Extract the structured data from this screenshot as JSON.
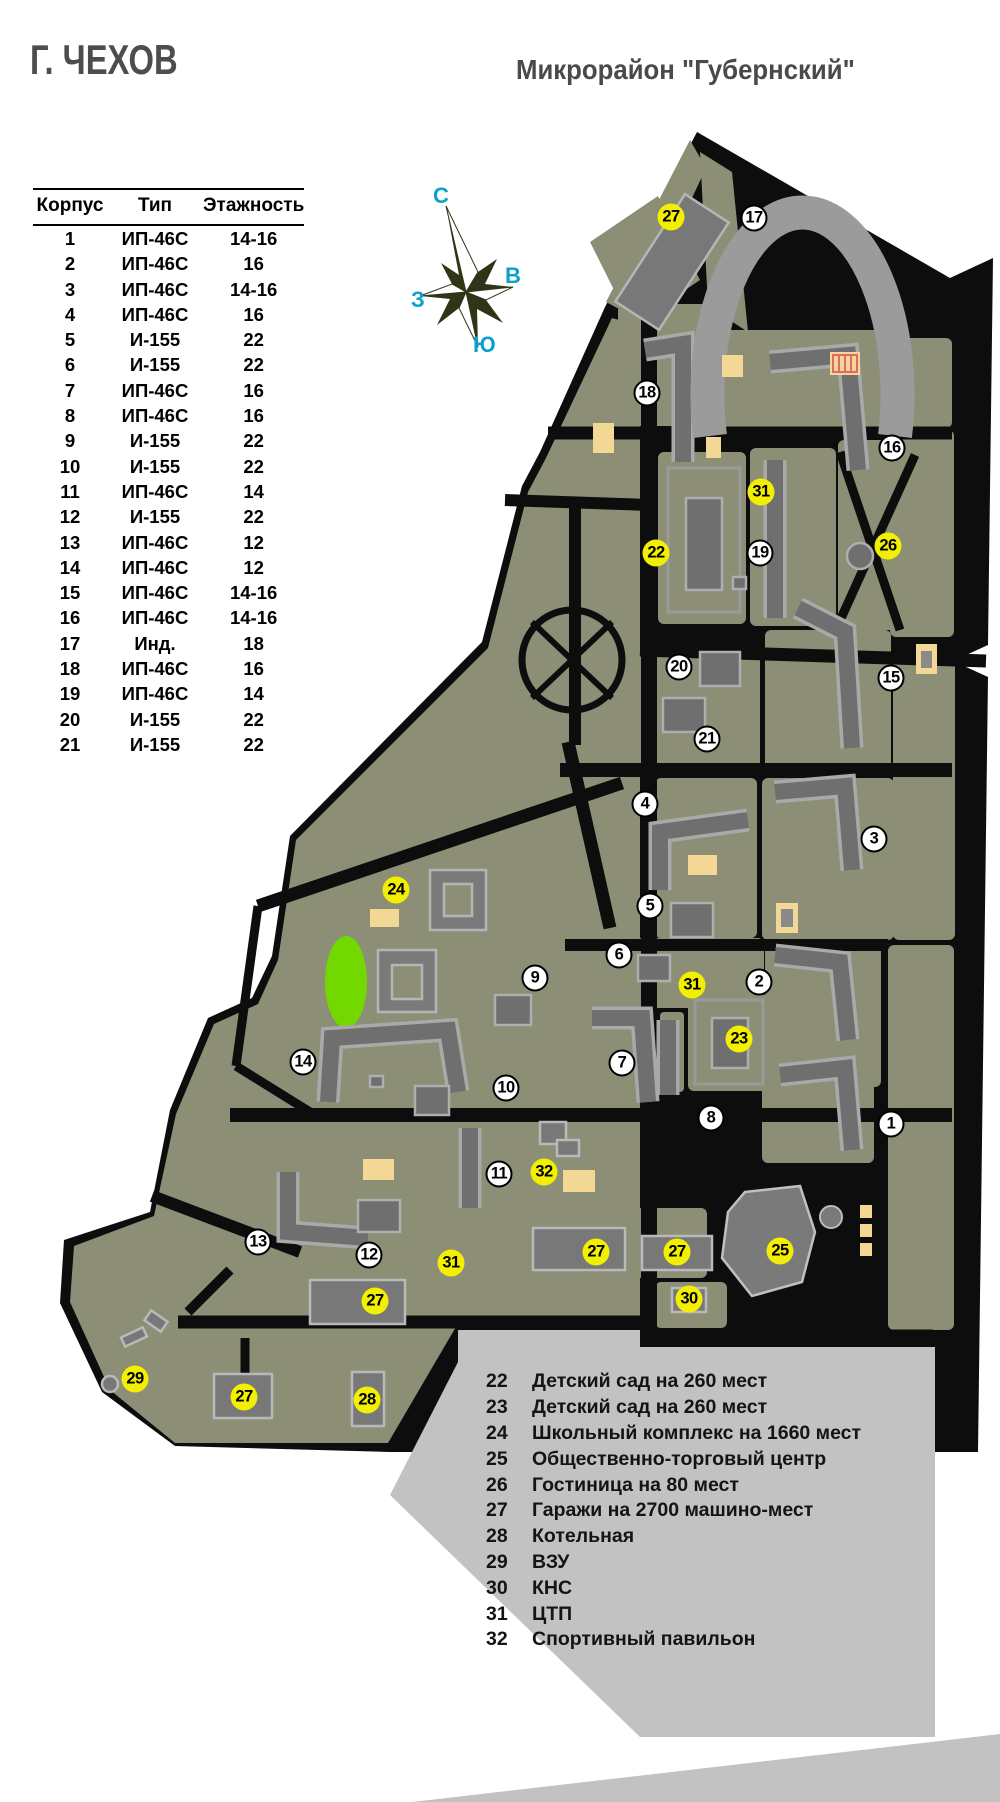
{
  "titles": {
    "city": "Г. ЧЕХОВ",
    "district": "Микрорайон \"Губернский\""
  },
  "table": {
    "headers": [
      "Корпус",
      "Тип",
      "Этажность"
    ],
    "rows": [
      [
        "1",
        "ИП-46С",
        "14-16"
      ],
      [
        "2",
        "ИП-46С",
        "16"
      ],
      [
        "3",
        "ИП-46С",
        "14-16"
      ],
      [
        "4",
        "ИП-46С",
        "16"
      ],
      [
        "5",
        "И-155",
        "22"
      ],
      [
        "6",
        "И-155",
        "22"
      ],
      [
        "7",
        "ИП-46С",
        "16"
      ],
      [
        "8",
        "ИП-46С",
        "16"
      ],
      [
        "9",
        "И-155",
        "22"
      ],
      [
        "10",
        "И-155",
        "22"
      ],
      [
        "11",
        "ИП-46С",
        "14"
      ],
      [
        "12",
        "И-155",
        "22"
      ],
      [
        "13",
        "ИП-46С",
        "12"
      ],
      [
        "14",
        "ИП-46С",
        "12"
      ],
      [
        "15",
        "ИП-46С",
        "14-16"
      ],
      [
        "16",
        "ИП-46С",
        "14-16"
      ],
      [
        "17",
        "Инд.",
        "18"
      ],
      [
        "18",
        "ИП-46С",
        "16"
      ],
      [
        "19",
        "ИП-46С",
        "14"
      ],
      [
        "20",
        "И-155",
        "22"
      ],
      [
        "21",
        "И-155",
        "22"
      ]
    ]
  },
  "compass": {
    "north": "С",
    "east": "В",
    "west": "З",
    "south": "Ю"
  },
  "legend": {
    "items": [
      {
        "num": "22",
        "label": "Детский сад на 260 мест"
      },
      {
        "num": "23",
        "label": "Детский сад на 260 мест"
      },
      {
        "num": "24",
        "label": "Школьный комплекс на 1660 мест"
      },
      {
        "num": "25",
        "label": "Общественно-торговый центр"
      },
      {
        "num": "26",
        "label": "Гостиница на 80 мест"
      },
      {
        "num": "27",
        "label": "Гаражи на 2700 машино-мест"
      },
      {
        "num": "28",
        "label": "Котельная"
      },
      {
        "num": "29",
        "label": "ВЗУ"
      },
      {
        "num": "30",
        "label": "КНС"
      },
      {
        "num": "31",
        "label": "ЦТП"
      },
      {
        "num": "32",
        "label": "Спортивный павильон"
      }
    ]
  },
  "map": {
    "markers": [
      {
        "num": "27",
        "color": "yellow",
        "x": 671,
        "y": 217
      },
      {
        "num": "17",
        "color": "white",
        "x": 754,
        "y": 218
      },
      {
        "num": "18",
        "color": "white",
        "x": 647,
        "y": 393
      },
      {
        "num": "16",
        "color": "white",
        "x": 892,
        "y": 448
      },
      {
        "num": "31",
        "color": "yellow",
        "x": 761,
        "y": 492
      },
      {
        "num": "26",
        "color": "yellow",
        "x": 888,
        "y": 546
      },
      {
        "num": "22",
        "color": "yellow",
        "x": 656,
        "y": 553
      },
      {
        "num": "19",
        "color": "white",
        "x": 760,
        "y": 553
      },
      {
        "num": "20",
        "color": "white",
        "x": 679,
        "y": 667
      },
      {
        "num": "15",
        "color": "white",
        "x": 891,
        "y": 678
      },
      {
        "num": "21",
        "color": "white",
        "x": 707,
        "y": 739
      },
      {
        "num": "4",
        "color": "white",
        "x": 645,
        "y": 804
      },
      {
        "num": "3",
        "color": "white",
        "x": 874,
        "y": 839
      },
      {
        "num": "24",
        "color": "yellow",
        "x": 396,
        "y": 890
      },
      {
        "num": "5",
        "color": "white",
        "x": 650,
        "y": 906
      },
      {
        "num": "6",
        "color": "white",
        "x": 619,
        "y": 955
      },
      {
        "num": "9",
        "color": "white",
        "x": 535,
        "y": 978
      },
      {
        "num": "31",
        "color": "yellow",
        "x": 692,
        "y": 985
      },
      {
        "num": "2",
        "color": "white",
        "x": 759,
        "y": 982
      },
      {
        "num": "23",
        "color": "yellow",
        "x": 739,
        "y": 1039
      },
      {
        "num": "14",
        "color": "white",
        "x": 303,
        "y": 1062
      },
      {
        "num": "7",
        "color": "white",
        "x": 622,
        "y": 1063
      },
      {
        "num": "10",
        "color": "white",
        "x": 506,
        "y": 1088
      },
      {
        "num": "8",
        "color": "white",
        "x": 711,
        "y": 1118
      },
      {
        "num": "1",
        "color": "white",
        "x": 891,
        "y": 1124
      },
      {
        "num": "11",
        "color": "white",
        "x": 499,
        "y": 1174
      },
      {
        "num": "32",
        "color": "yellow",
        "x": 544,
        "y": 1172
      },
      {
        "num": "13",
        "color": "white",
        "x": 258,
        "y": 1242
      },
      {
        "num": "12",
        "color": "white",
        "x": 369,
        "y": 1255
      },
      {
        "num": "31",
        "color": "yellow",
        "x": 451,
        "y": 1263
      },
      {
        "num": "27",
        "color": "yellow",
        "x": 596,
        "y": 1252
      },
      {
        "num": "27",
        "color": "yellow",
        "x": 677,
        "y": 1252
      },
      {
        "num": "25",
        "color": "yellow",
        "x": 780,
        "y": 1251
      },
      {
        "num": "30",
        "color": "yellow",
        "x": 689,
        "y": 1299
      },
      {
        "num": "27",
        "color": "yellow",
        "x": 375,
        "y": 1301
      },
      {
        "num": "29",
        "color": "yellow",
        "x": 135,
        "y": 1379
      },
      {
        "num": "27",
        "color": "yellow",
        "x": 244,
        "y": 1397
      },
      {
        "num": "28",
        "color": "yellow",
        "x": 367,
        "y": 1400
      }
    ]
  },
  "colors": {
    "land": "#8c8f76",
    "road": "#0d0d0d",
    "building": "#6f6f6f",
    "building_light": "#9b9b9b",
    "sand": "#f3d795",
    "stadium_green": "#72d800",
    "legend_bg": "#c2c2c2",
    "marker_yellow": "#f2ef00",
    "title_gray": "#4d4d4d",
    "compass_cyan": "#0aa2cc"
  }
}
